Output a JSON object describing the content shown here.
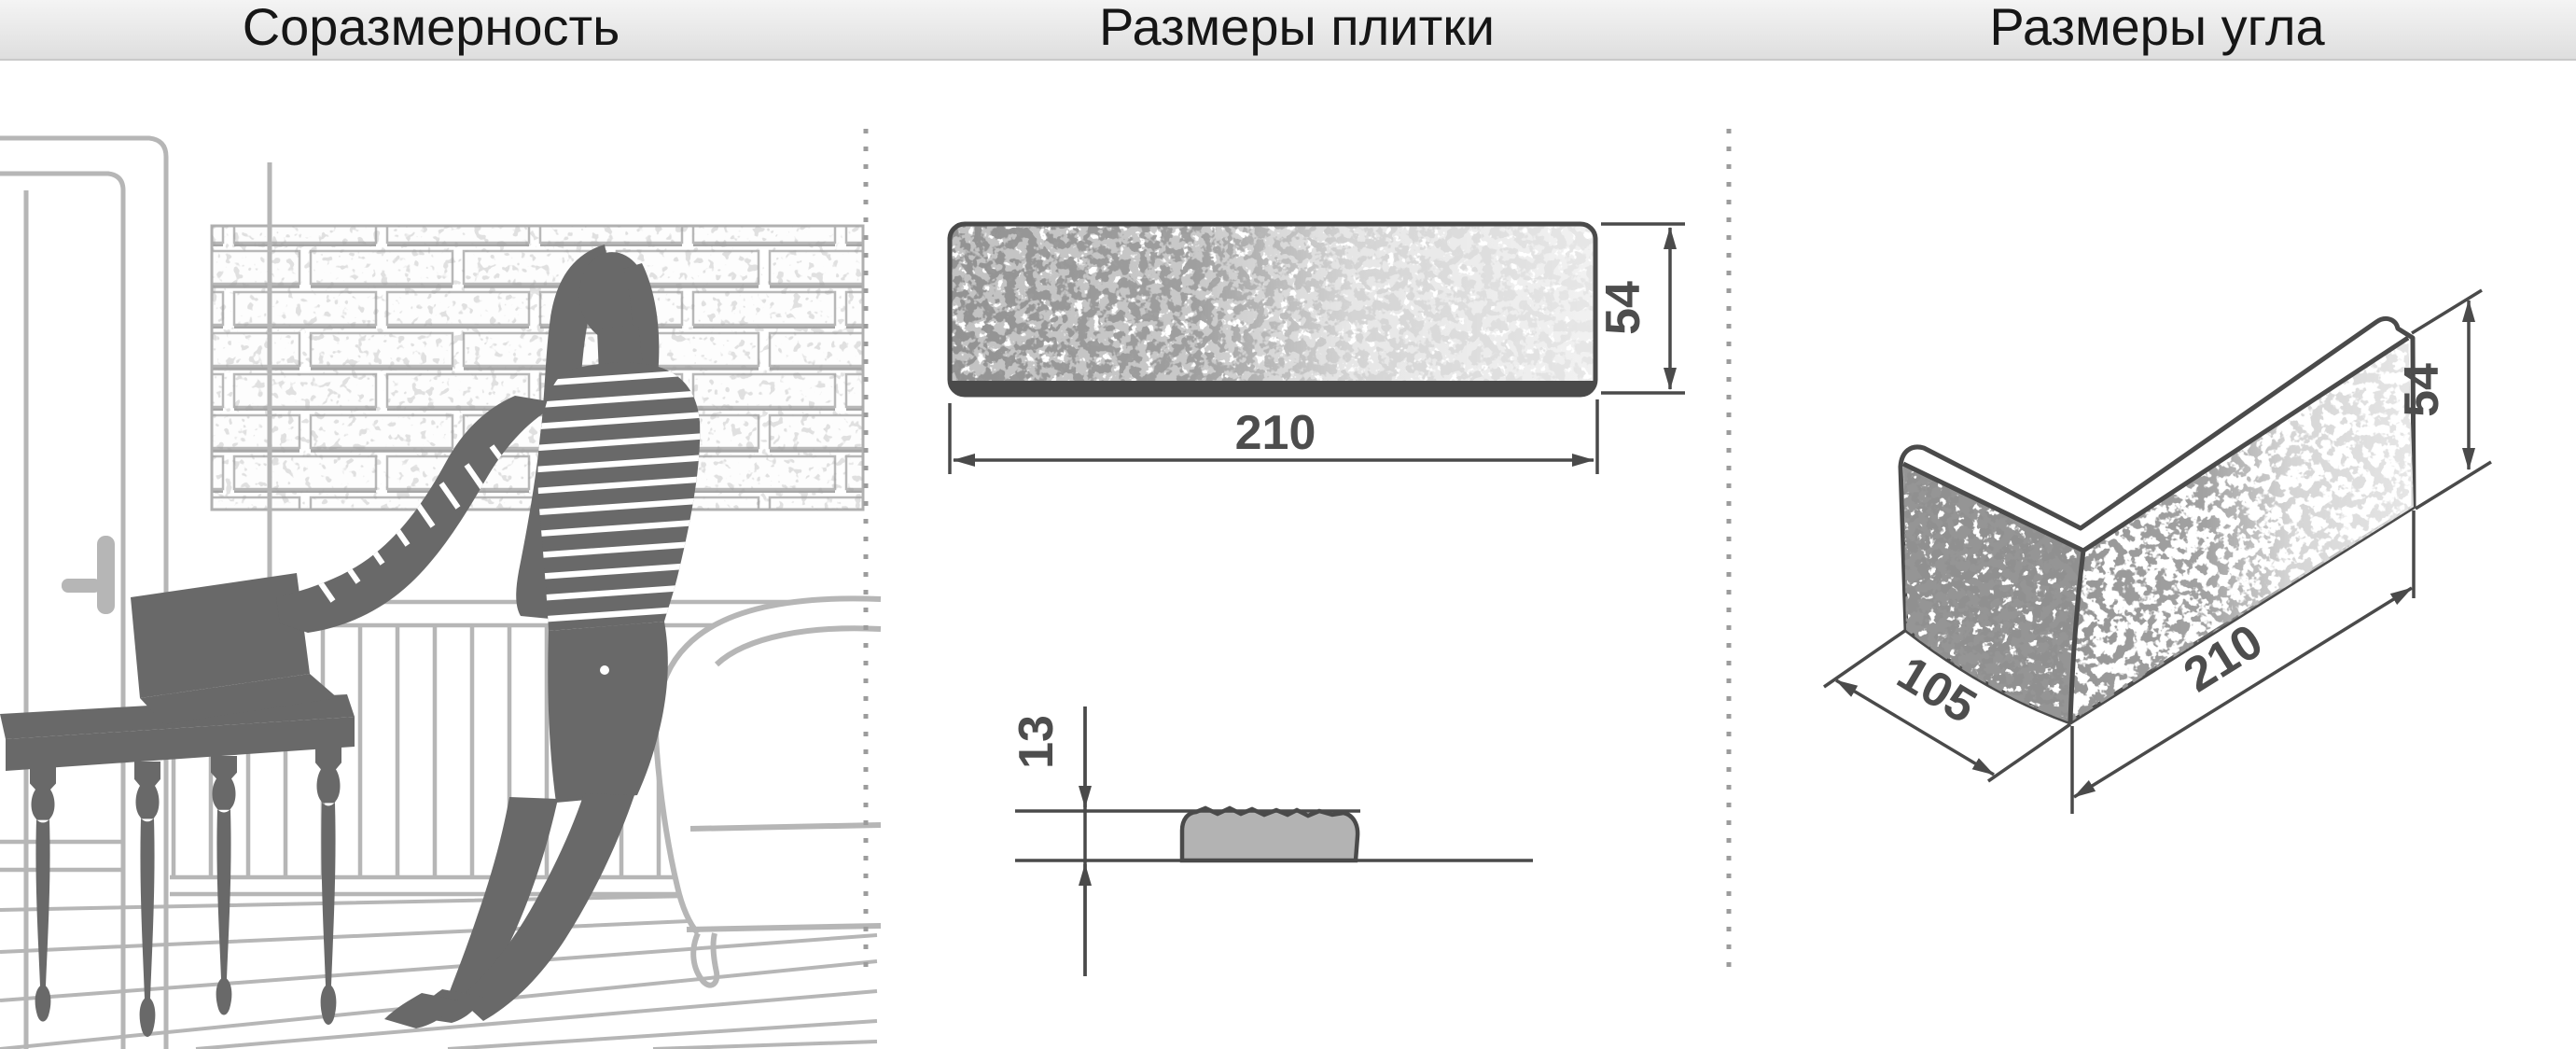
{
  "header": {
    "sections": [
      {
        "title": "Соразмерность"
      },
      {
        "title": "Размеры плитки"
      },
      {
        "title": "Размеры угла"
      }
    ]
  },
  "tile": {
    "length_mm": "210",
    "height_mm": "54",
    "thickness_mm": "13"
  },
  "corner": {
    "short_leg_mm": "105",
    "long_leg_mm": "210",
    "height_mm": "54"
  },
  "colors": {
    "dimension_line": "#4a4a4a",
    "dimension_text": "#4d4d4d",
    "silhouette": "#696969",
    "furniture_outline": "#b6b6b6",
    "brick_mortar": "#b8b8b8",
    "profile_fill": "#b3b3b3",
    "header_background": "#ececec"
  }
}
